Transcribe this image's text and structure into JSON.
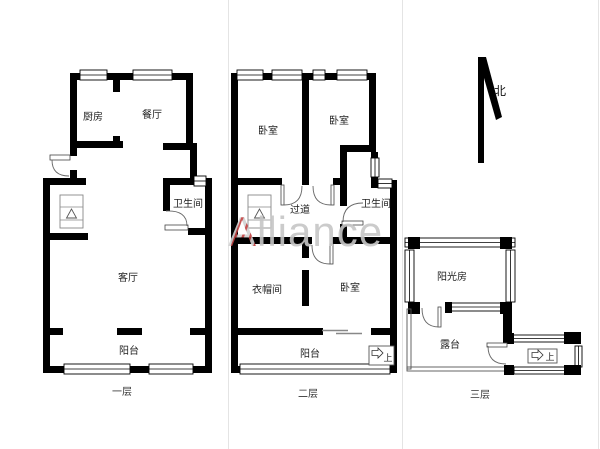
{
  "watermark": {
    "prefix": "A",
    "suffix": "lliance",
    "red": "#c24040",
    "gray": "#c6c6c6"
  },
  "compass": {
    "north_label": "北"
  },
  "colors": {
    "wall": "#000000",
    "background": "#ffffff"
  },
  "floors": {
    "floor1": {
      "label": "一层",
      "rooms": {
        "kitchen": "厨房",
        "dining": "餐厅",
        "bathroom": "卫生间",
        "living": "客厅",
        "balcony": "阳台"
      }
    },
    "floor2": {
      "label": "二层",
      "rooms": {
        "bedroom_left": "卧室",
        "bedroom_right": "卧室",
        "corridor": "过道",
        "bathroom": "卫生间",
        "cloakroom": "衣帽间",
        "bedroom_south": "卧室",
        "balcony": "阳台"
      },
      "stair_label": "上"
    },
    "floor3": {
      "label": "三层",
      "rooms": {
        "sunroom": "阳光房",
        "terrace": "露台"
      },
      "stair_label": "上"
    }
  }
}
